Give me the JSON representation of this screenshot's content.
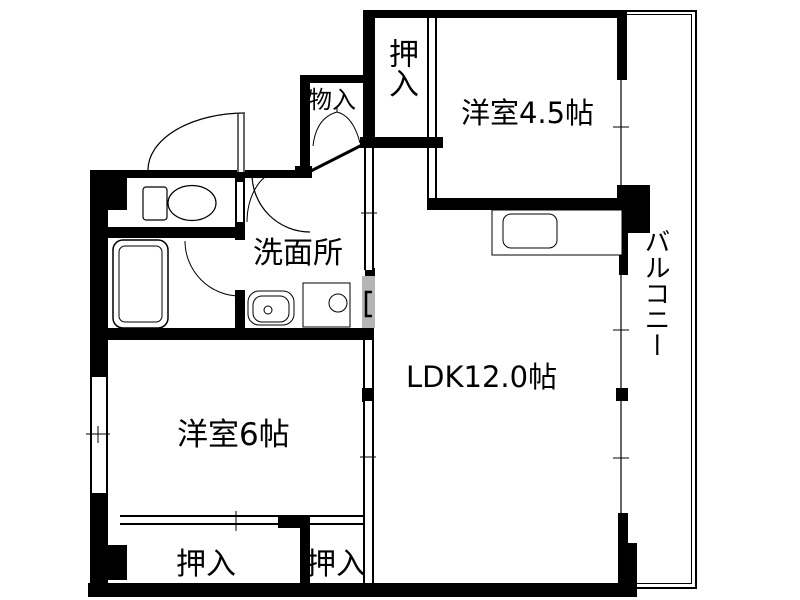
{
  "plan_type": "apartment-floor-plan",
  "rooms": {
    "closet_top": {
      "label": "押入"
    },
    "storage": {
      "label": "物入"
    },
    "western_room_45": {
      "label": "洋室4.5帖"
    },
    "balcony": {
      "label": "バルコニー"
    },
    "washroom": {
      "label": "洗面所"
    },
    "ldk": {
      "label": "LDK12.0帖"
    },
    "western_room_6": {
      "label": "洋室6帖"
    },
    "closet_bottom_left": {
      "label": "押入"
    },
    "closet_bottom_right": {
      "label": "押入"
    }
  },
  "colors": {
    "wall": "#000000",
    "background": "#ffffff",
    "door_panel_gray": "#b5b5b5"
  }
}
